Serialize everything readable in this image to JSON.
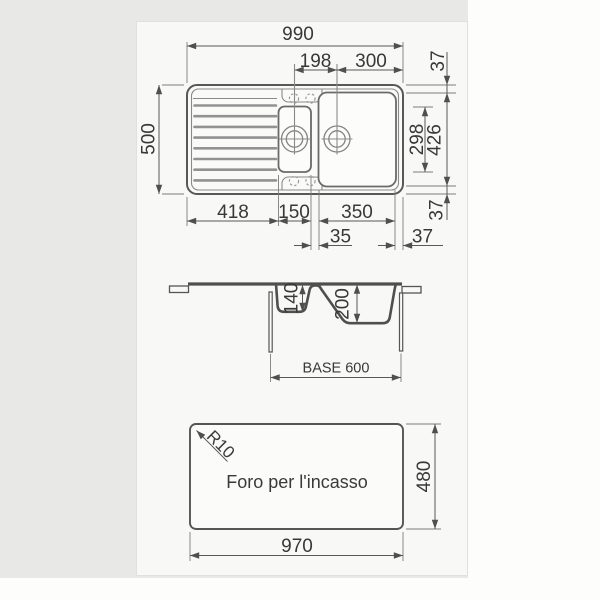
{
  "colors": {
    "background_strip": "#e8e8e6",
    "paper": "#f8f8f6",
    "line": "#4f4f4f",
    "dimension_line": "#595959",
    "text": "#383838"
  },
  "plan_view": {
    "overall_width": "990",
    "bowl_center_spacing": "198",
    "bowl_center_to_edge": "300",
    "top_rim": "37",
    "overall_depth": "500",
    "small_bowl_length": "298",
    "large_bowl_length": "426",
    "bottom_rim": "37",
    "drainboard_width": "418",
    "small_bowl_width": "150",
    "large_bowl_width": "350",
    "divider_width": "35",
    "right_rim": "37"
  },
  "section_view": {
    "small_bowl_depth": "140",
    "large_bowl_depth": "200",
    "base_label": "BASE 600"
  },
  "cutout_view": {
    "label": "Foro per l'incasso",
    "corner_radius": "R10",
    "cutout_height": "480",
    "cutout_width": "970"
  }
}
